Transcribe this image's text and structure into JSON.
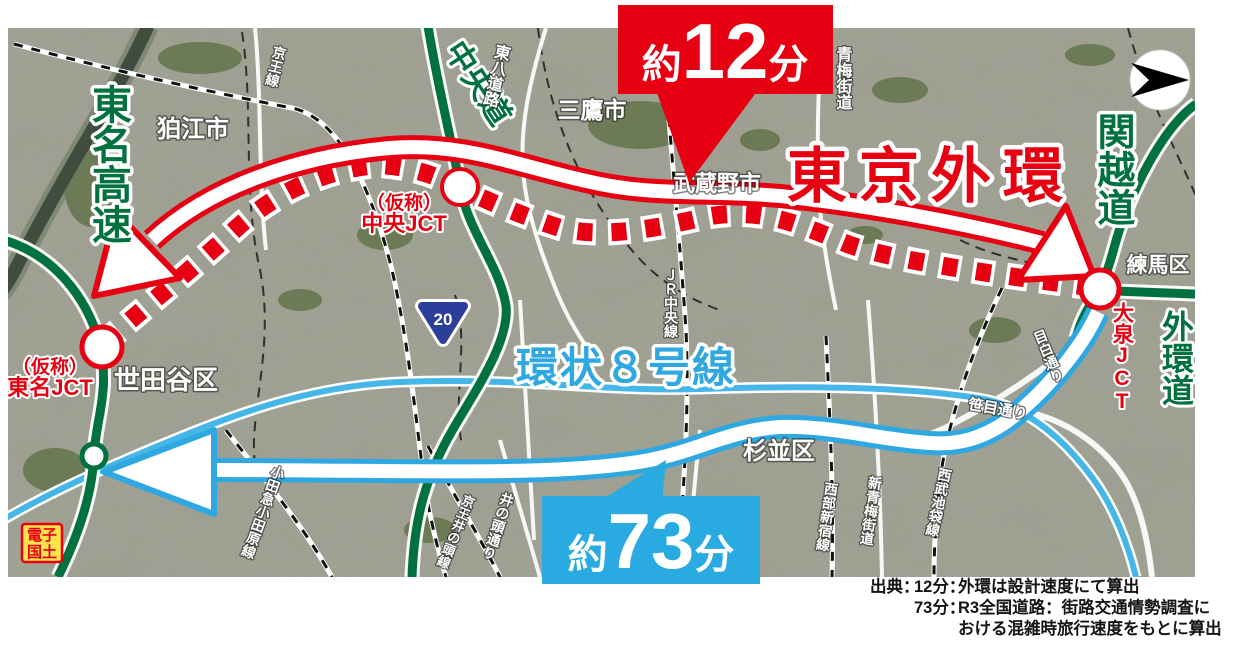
{
  "colors": {
    "accent_red": "#e60012",
    "callout_blue": "#29abe2",
    "route_line_blue": "#2fa8e1",
    "expressway_green": "#00713f",
    "shield_blue": "#2b3e9a",
    "stamp_yellow": "#ffe34a"
  },
  "callouts": {
    "gaikan": {
      "prefix": "約",
      "value": "12",
      "suffix": "分"
    },
    "kanjo8": {
      "prefix": "約",
      "value": "73",
      "suffix": "分"
    }
  },
  "routes": {
    "gaikan_title": "東京外環",
    "kanjo8_title": "環状８号線"
  },
  "expressways": {
    "tomei": "東名高速",
    "chuo": "中央道",
    "kanetsu": "関越道",
    "gaikan": "外環道"
  },
  "junctions": {
    "tomei_l1": "（仮称）",
    "tomei_l2": "東名JCT",
    "chuo_l1": "（仮称）",
    "chuo_l2": "中央JCT",
    "oizumi": "大泉JCT"
  },
  "areas": {
    "komae": "狛江市",
    "mitaka": "三鷹市",
    "musashino": "武蔵野市",
    "setagaya": "世田谷区",
    "suginami": "杉並区",
    "nerima": "練馬区"
  },
  "roads_rails": {
    "keio": "京王線",
    "tohachi": "東八道路",
    "ome_kaido": "青梅街道",
    "jr_chuo": "ＪＲ中央線",
    "inokashira_dori": "井の頭通り",
    "keio_inokashira": "京王井の頭線",
    "odakyu": "小田急小田原線",
    "seibu_shinjuku": "西部新宿線",
    "shin_ome_kaido": "新青梅街道",
    "seibu_ikebukuro": "西武池袋線",
    "mejiro_dori": "目白通り",
    "sasame_dori": "笹目通り"
  },
  "route_shield": {
    "number": "20"
  },
  "stamp": {
    "line1": "電子",
    "line2": "国土"
  },
  "source": {
    "label": "出典：",
    "row1_key": "12分：",
    "row1_text": "外環は設計速度にて算出",
    "row2_key": "73分：",
    "row2_text": "R3全国道路：街路交通情勢調査に",
    "row3_text": "おける混雑時旅行速度をもとに算出"
  }
}
